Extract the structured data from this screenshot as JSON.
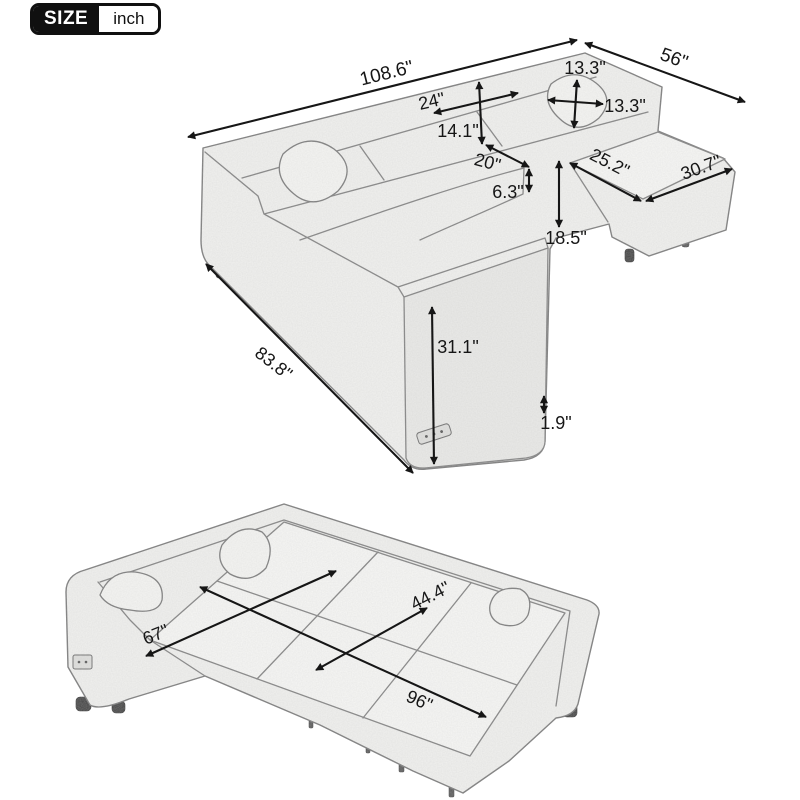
{
  "badge": {
    "size_label": "SIZE",
    "unit_label": "inch"
  },
  "assembled_view": {
    "dims": {
      "overall_width": "108.6\"",
      "chaise_side_depth": "56\"",
      "pillow_height": "13.3\"",
      "pillow_width": "13.3\"",
      "back_cushion_width": "24\"",
      "back_cushion_height": "14.1\"",
      "seat_depth": "20\"",
      "seat_cushion_thickness": "6.3\"",
      "ottoman_width": "25.2\"",
      "ottoman_length": "30.7\"",
      "seat_height": "18.5\"",
      "left_side_length": "83.8\"",
      "arm_height": "31.1\"",
      "leg_height": "1.9\""
    }
  },
  "bed_view": {
    "dims": {
      "bed_width": "67\"",
      "sleeper_depth": "44.4\"",
      "bed_length": "96\""
    }
  }
}
